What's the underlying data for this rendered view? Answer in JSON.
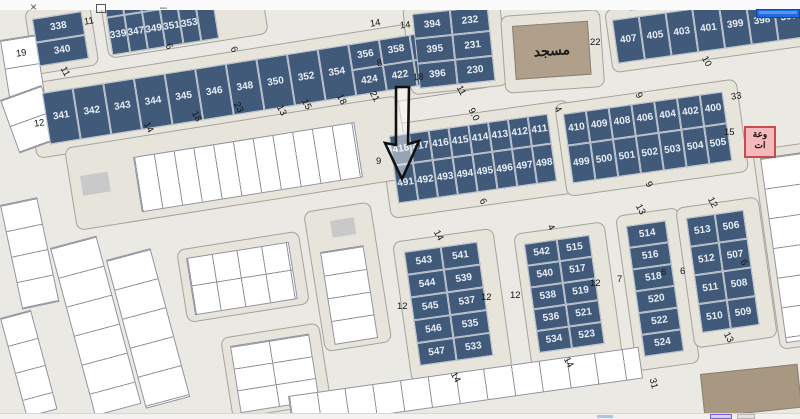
{
  "window": {
    "controls": {
      "close_glyph": "×",
      "minimize_glyph": "–",
      "restore_icon": "window-restore-box"
    }
  },
  "map": {
    "mosque_label": "مسجد",
    "pink_box": {
      "line1": "وعة",
      "line2": "ات"
    },
    "arrow": {
      "points_to": "491"
    }
  },
  "plots": {
    "col338": [
      "338",
      "340"
    ],
    "row339": [
      "336",
      "",
      "",
      "",
      "",
      "",
      "339",
      "347",
      "349",
      "351",
      "353",
      ""
    ],
    "row341": [
      "341",
      "342",
      "343",
      "344",
      "345",
      "346",
      "348",
      "350",
      "352",
      "354"
    ],
    "row356_424": [
      "356",
      "358",
      "360",
      "362",
      "424",
      "422",
      "420",
      "419"
    ],
    "block394": [
      "394",
      "232",
      "395",
      "231",
      "396",
      "230"
    ],
    "row407": [
      "407",
      "405",
      "403",
      "401",
      "399",
      "398",
      "397"
    ],
    "strip417": [
      "418",
      "417",
      "416",
      "415",
      "414",
      "413",
      "412",
      "411",
      "491",
      "492",
      "493",
      "494",
      "495",
      "496",
      "497",
      "498"
    ],
    "strip410": [
      "410",
      "409",
      "408",
      "406",
      "404",
      "402",
      "400",
      "499",
      "500",
      "501",
      "502",
      "503",
      "504",
      "505"
    ],
    "block543": [
      "543",
      "541",
      "544",
      "539",
      "545",
      "537",
      "546",
      "535",
      "547",
      "533"
    ],
    "block542": [
      "542",
      "515",
      "540",
      "517",
      "538",
      "519",
      "536",
      "521",
      "534",
      "523"
    ],
    "col514": [
      "514",
      "516",
      "518",
      "520",
      "522",
      "524"
    ],
    "block513": [
      "513",
      "506",
      "512",
      "507",
      "511",
      "508",
      "510",
      "509"
    ]
  },
  "dims": [
    {
      "t": "11",
      "x": 84,
      "y": 16,
      "r": -9
    },
    {
      "t": "19",
      "x": 16,
      "y": 48,
      "r": -9
    },
    {
      "t": "11",
      "x": 60,
      "y": 66,
      "r": 62
    },
    {
      "t": "12",
      "x": 34,
      "y": 118,
      "r": -9
    },
    {
      "t": "14",
      "x": 143,
      "y": 122,
      "r": 62
    },
    {
      "t": "18",
      "x": 191,
      "y": 111,
      "r": 62
    },
    {
      "t": "23",
      "x": 233,
      "y": 102,
      "r": 62
    },
    {
      "t": "13",
      "x": 276,
      "y": 105,
      "r": 62
    },
    {
      "t": "15",
      "x": 301,
      "y": 99,
      "r": 62
    },
    {
      "t": "18",
      "x": 336,
      "y": 94,
      "r": 62
    },
    {
      "t": "21",
      "x": 369,
      "y": 91,
      "r": 62
    },
    {
      "t": "8",
      "x": 377,
      "y": 58,
      "r": -9
    },
    {
      "t": "14",
      "x": 370,
      "y": 18,
      "r": -9
    },
    {
      "t": "6",
      "x": 166,
      "y": 41,
      "r": 62
    },
    {
      "t": "6",
      "x": 231,
      "y": 44,
      "r": 62
    },
    {
      "t": "14",
      "x": 400,
      "y": 20,
      "r": -6
    },
    {
      "t": "18",
      "x": 413,
      "y": 72,
      "r": -6
    },
    {
      "t": "11",
      "x": 456,
      "y": 85,
      "r": 62
    },
    {
      "t": "22",
      "x": 590,
      "y": 37,
      "r": 0
    },
    {
      "t": "10",
      "x": 701,
      "y": 56,
      "r": 62
    },
    {
      "t": "33",
      "x": 731,
      "y": 91,
      "r": -8
    },
    {
      "t": "15",
      "x": 724,
      "y": 127,
      "r": 0
    },
    {
      "t": "9.0",
      "x": 467,
      "y": 109,
      "r": 62
    },
    {
      "t": "4",
      "x": 555,
      "y": 104,
      "r": 62
    },
    {
      "t": "9",
      "x": 376,
      "y": 156,
      "r": 0
    },
    {
      "t": "6",
      "x": 480,
      "y": 196,
      "r": 62
    },
    {
      "t": "9",
      "x": 636,
      "y": 90,
      "r": 62
    },
    {
      "t": "9",
      "x": 646,
      "y": 179,
      "r": 62
    },
    {
      "t": "14",
      "x": 433,
      "y": 230,
      "r": 62
    },
    {
      "t": "12",
      "x": 397,
      "y": 301,
      "r": 0
    },
    {
      "t": "12",
      "x": 481,
      "y": 292,
      "r": 0
    },
    {
      "t": "14",
      "x": 450,
      "y": 372,
      "r": 62
    },
    {
      "t": "4",
      "x": 548,
      "y": 222,
      "r": 62
    },
    {
      "t": "12",
      "x": 510,
      "y": 290,
      "r": 0
    },
    {
      "t": "14",
      "x": 563,
      "y": 357,
      "r": 62
    },
    {
      "t": "12",
      "x": 590,
      "y": 278,
      "r": 0
    },
    {
      "t": "7",
      "x": 617,
      "y": 274,
      "r": 0
    },
    {
      "t": "13",
      "x": 635,
      "y": 204,
      "r": 62
    },
    {
      "t": "6",
      "x": 661,
      "y": 267,
      "r": 0
    },
    {
      "t": "31",
      "x": 648,
      "y": 378,
      "r": 76
    },
    {
      "t": "12",
      "x": 707,
      "y": 197,
      "r": 62
    },
    {
      "t": "6",
      "x": 680,
      "y": 266,
      "r": 0
    },
    {
      "t": "6",
      "x": 741,
      "y": 257,
      "r": 62
    },
    {
      "t": "13",
      "x": 723,
      "y": 332,
      "r": 62
    }
  ],
  "colors": {
    "parcel_fill": "#415a7a",
    "parcel_text": "#e7edf4",
    "road": "#ebe9e4",
    "plate": "#e7e4dc",
    "mosque_fill": "#b0a08b",
    "annotation_pink_fill": "#f3b9bc",
    "annotation_pink_border": "#c94b4b",
    "blue_bar": "#1f6ae0",
    "gray_box": "#c9c9c9",
    "tan_building": "#a89781"
  }
}
